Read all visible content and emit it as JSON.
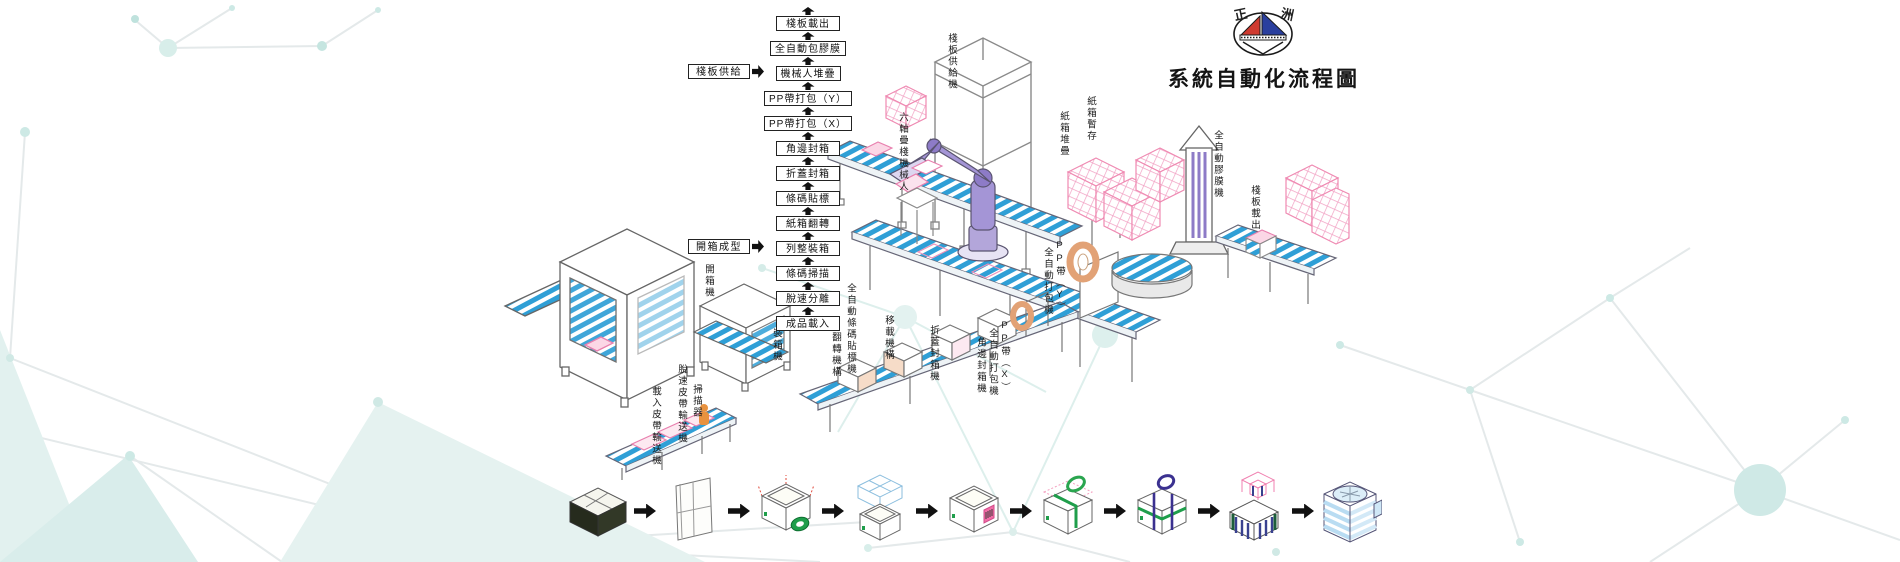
{
  "brand": {
    "logo_text_left": "正",
    "logo_text_right": "洲",
    "title": "系統自動化流程圖"
  },
  "flow_chain": {
    "steps": [
      "棧板載出",
      "全自動包膠膜",
      "機械人堆疊",
      "PP帶打包（Y）",
      "PP帶打包（X）",
      "角邊封箱",
      "折蓋封箱",
      "條碼貼標",
      "紙箱翻轉",
      "列整裝箱",
      "條碼掃描",
      "脫速分離",
      "成品載入"
    ],
    "inputs": [
      "棧板供給",
      "開箱成型"
    ]
  },
  "machine_labels": {
    "loading_belt_conveyor": "載入皮帶輸送機",
    "release_belt_conveyor": "脫速皮帶輸送機",
    "scanner": "掃描器",
    "carton_opening_machine": "開箱機",
    "carton_packing_machine": "裝箱機",
    "flip_mechanism": "翻轉機構",
    "auto_barcode_labeler": "全自動條碼貼標機",
    "transfer_mechanism": "移載機構",
    "flap_sealing_machine": "折蓋封箱機",
    "corner_sealing_machine": "角邊封箱機",
    "pp_band_x": "PP帶（X）",
    "pp_band_x_machine": "全自動打包機",
    "pp_band_y": "PP帶（Y）",
    "pp_band_y_machine": "全自動打包機",
    "six_axis_robot": "六軸疊棧機械人",
    "pallet_supply_machine": "棧板供給機",
    "carton_stacking": "紙箱堆疊",
    "carton_buffer": "紙箱暫存",
    "auto_wrapping_machine": "全自動膠膜機",
    "pallet_out": "棧板載出"
  },
  "product_flow": {
    "step_icons": [
      "flat-carton-stack-icon",
      "folded-flat-carton-icon",
      "carton-forming-tape-icon",
      "carton-loading-icon",
      "carton-labeling-icon",
      "carton-strapping-single-icon",
      "carton-strapping-double-icon",
      "robot-palletizing-icon",
      "pallet-wrapping-icon"
    ]
  },
  "icons": {
    "up_arrow": "solid-black-block-up-arrow",
    "right_arrow": "solid-black-block-right-arrow"
  },
  "colors": {
    "belt_blue": "#2f9fd6",
    "carton_pink": "#ef87b2",
    "robot_purple": "#8d7bc7",
    "logo_red": "#cf3a30",
    "logo_blue": "#2a3f9e",
    "tape_green": "#1f9e4b",
    "strap_purple": "#3b3190",
    "coil_orange": "#e2a276",
    "decor_teal": "#d9edeb",
    "ink": "#111111"
  }
}
